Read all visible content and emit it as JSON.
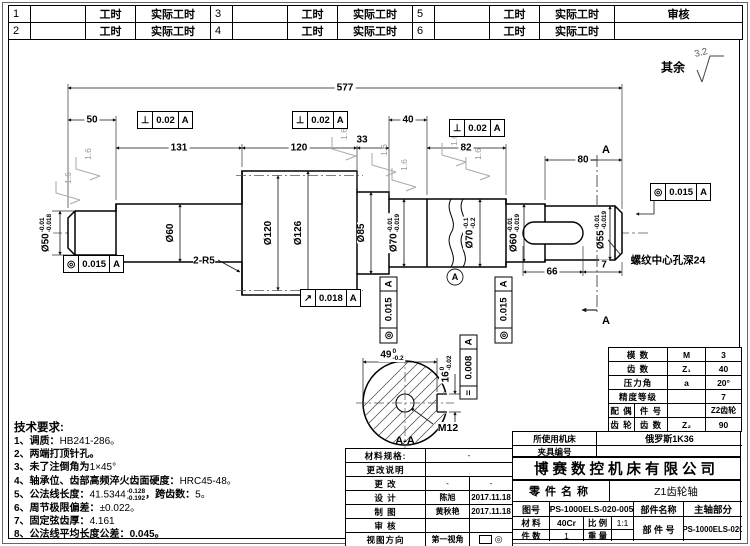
{
  "header": {
    "r1": [
      "1",
      "",
      "工时",
      "实际工时",
      "3",
      "",
      "工时",
      "实际工时",
      "5",
      "",
      "工时",
      "实际工时",
      "审核"
    ],
    "r2": [
      "2",
      "",
      "工时",
      "实际工时",
      "4",
      "",
      "工时",
      "实际工时",
      "6",
      "",
      "工时",
      "实际工时",
      ""
    ]
  },
  "finish": {
    "rest_label": "其余",
    "rest_value": "3.2",
    "mark": "1.6"
  },
  "dims": {
    "overall": "577",
    "len50": "50",
    "len131": "131",
    "len120": "120",
    "len33": "33",
    "len40": "40",
    "len82": "82",
    "len80": "80",
    "len66": "66",
    "len7": "7",
    "len49": "49",
    "len49_up": "0",
    "len49_low": "-0.2",
    "len16": "16",
    "len16_up": "0",
    "len16_low": "-0.02"
  },
  "dia": {
    "d50": {
      "t": "Ø50",
      "up": "-0.01",
      "low": "-0.018"
    },
    "d60": {
      "t": "Ø60"
    },
    "d120": {
      "t": "Ø120"
    },
    "d126": {
      "t": "Ø126"
    },
    "d85": {
      "t": "Ø85"
    },
    "d70a": {
      "t": "Ø70",
      "up": "-0.01",
      "low": "-0.019"
    },
    "d70b": {
      "t": "Ø70",
      "up": "-0.1",
      "low": "-0.2"
    },
    "d60b": {
      "t": "Ø60",
      "up": "-0.01",
      "low": "-0.019"
    },
    "d55": {
      "t": "Ø55",
      "up": "-0.01",
      "low": "-0.019"
    }
  },
  "gdt": {
    "perp": {
      "sym": "⊥",
      "val": "0.02",
      "ref": "A"
    },
    "conc015": {
      "sym": "◎",
      "val": "0.015",
      "ref": "A"
    },
    "runout": {
      "sym": "↗",
      "val": "0.018",
      "ref": "A"
    },
    "sym008": {
      "sym": "=",
      "val": "0.008",
      "ref": "A"
    }
  },
  "labels": {
    "fillet": "2-R5",
    "thread_hole": "M12",
    "center_note": "螺纹中心孔深24",
    "section": "A-A",
    "section_arrow": "A",
    "datum": "A"
  },
  "notes": {
    "title": "技术要求:",
    "n1b": "1、调质：",
    "n1t": "HB241-286。",
    "n2b": "2、两端打顶针孔。",
    "n2t": "",
    "n3b": "3、未了注倒角为",
    "n3t": "1×45°",
    "n4b": "4、轴承位、齿部高频淬火齿面硬度：",
    "n4t": "HRC45-48。",
    "n5a": "5、公法线长度：",
    "n5v": "41.5344",
    "n5up": "-0.128",
    "n5low": "-0.192",
    "n5b": "，跨齿数：",
    "n5c": "5。",
    "n6b": "6、周节极限偏差：",
    "n6t": "±0.022。",
    "n7b": "7、固定弦齿厚：",
    "n7t": "4.161",
    "n8b": "8、公法线平均长度公差：",
    "n8t": "0.045。"
  },
  "signoff": {
    "mat_spec_label": "材料规格:",
    "mat_spec": "-",
    "change_note_label": "更改说明",
    "change_label": "更 改",
    "change_v1": "-",
    "change_v2": "-",
    "design_label": "设 计",
    "design_name": "陈旭",
    "design_date": "2017.11.18",
    "draw_label": "制 图",
    "draw_name": "黄秋艳",
    "draw_date": "2017.11.18",
    "check_label": "审 核",
    "view_label": "视图方向",
    "view_value": "第一视角"
  },
  "gear": {
    "m_label": "模 数",
    "m_sym": "M",
    "m_val": "3",
    "z_label": "齿 数",
    "z_sym": "Z₁",
    "z_val": "40",
    "pa_label": "压力角",
    "pa_sym": "a",
    "pa_val": "20°",
    "acc_label": "精度等级",
    "acc_val": "7",
    "mate1": "配 偶",
    "mate2": "齿 轮",
    "pn_label": "件 号",
    "pn_val": "Z2齿轮",
    "z2_label": "齿 数",
    "z2_sym": "Z₂",
    "z2_val": "90"
  },
  "machine": {
    "label1": "所使用机床",
    "value1": "俄罗斯1K36",
    "label2": "夹具编号",
    "value2": ""
  },
  "company": "博赛数控机床有限公司",
  "part": {
    "name_label": "零件名称",
    "name": "Z1齿轮轴",
    "dwg_label": "图号",
    "dwg_no": "PS-1000ELS-020-005",
    "asm_name_label": "部件名称",
    "asm_name": "主轴部分",
    "mat_label": "材 料",
    "material": "40Cr",
    "scale_label": "比 例",
    "scale": "1:1",
    "asm_no_label": "部 件 号",
    "asm_no": "PS-1000ELS-020",
    "qty_label": "件 数",
    "qty": "1",
    "weight_label": "重 量",
    "weight": ""
  }
}
